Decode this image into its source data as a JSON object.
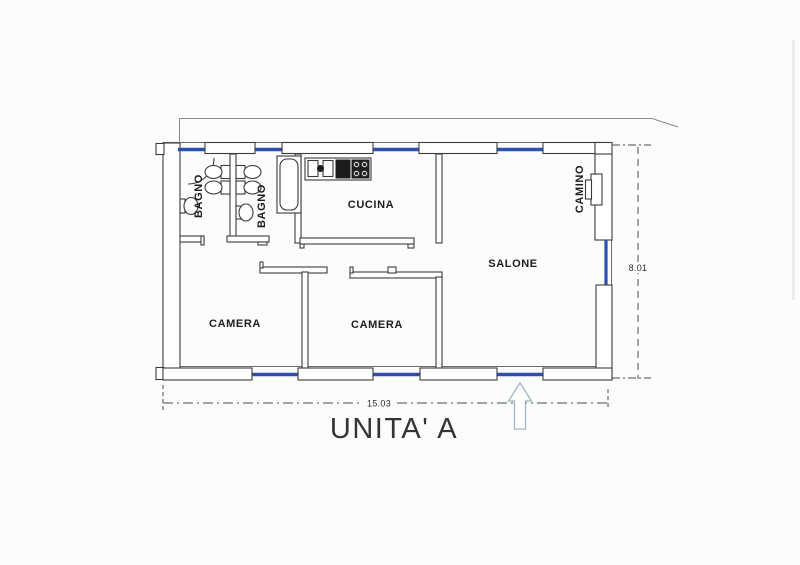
{
  "plan": {
    "unit_title": "UNITA' A",
    "rooms": [
      {
        "id": "bagno-1",
        "label": "BAGNO"
      },
      {
        "id": "bagno-2",
        "label": "BAGNO"
      },
      {
        "id": "cucina",
        "label": "CUCINA"
      },
      {
        "id": "salone",
        "label": "SALONE"
      },
      {
        "id": "camera-1",
        "label": "CAMERA"
      },
      {
        "id": "camera-2",
        "label": "CAMERA"
      },
      {
        "id": "camino",
        "label": "CAMINO"
      }
    ],
    "dimensions": {
      "width_label": "15.03",
      "height_label": "8.01"
    },
    "icons": {
      "entrance_arrow": "up-arrow-outline",
      "fixture_glyphs": [
        "door-arc",
        "sink",
        "toilet",
        "bidet",
        "bathtub",
        "stove",
        "fireplace",
        "window"
      ]
    },
    "colors": {
      "window_blue": "#2b50ae",
      "wall_line": "#3c3c3c",
      "arrow_outline": "#9db5c4",
      "dimension_line": "#4a4a4a",
      "paper": "#fcfcfa"
    }
  }
}
